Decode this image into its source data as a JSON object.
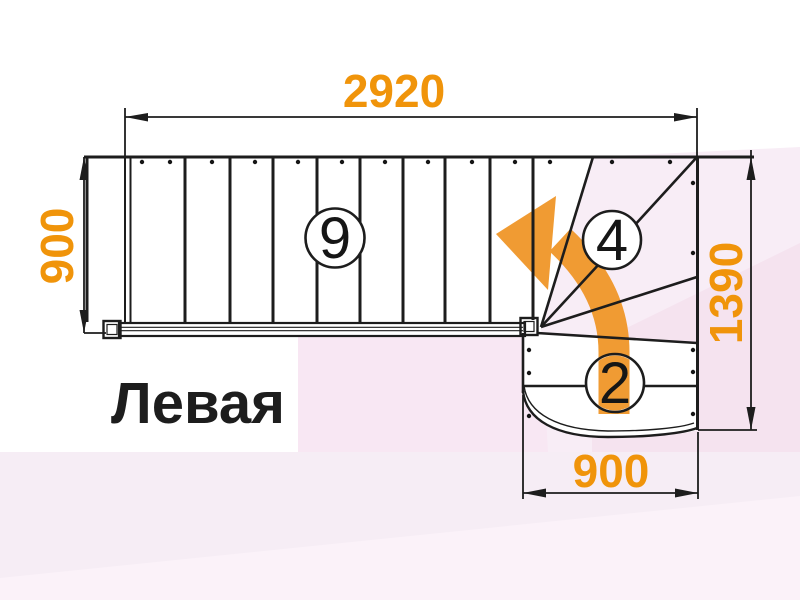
{
  "title": "Левая",
  "dimensions": {
    "top_length": "2920",
    "left_width": "900",
    "right_height": "1390",
    "bottom_width": "900"
  },
  "steps": {
    "upper_flight_count": "9",
    "winder_count": "4",
    "lower_flight_count": "2"
  },
  "colors": {
    "accent_orange": "#F0940A",
    "arrow_orange": "#F09B33",
    "line_black": "#1D1D1D",
    "pink_rect": "#F8E7F3",
    "pink_right": "#F8EDF6",
    "pink_right_deep": "#F5E3EF",
    "pink_bottom": "#F6EDF5",
    "pink_pale": "#FBF2F9"
  }
}
